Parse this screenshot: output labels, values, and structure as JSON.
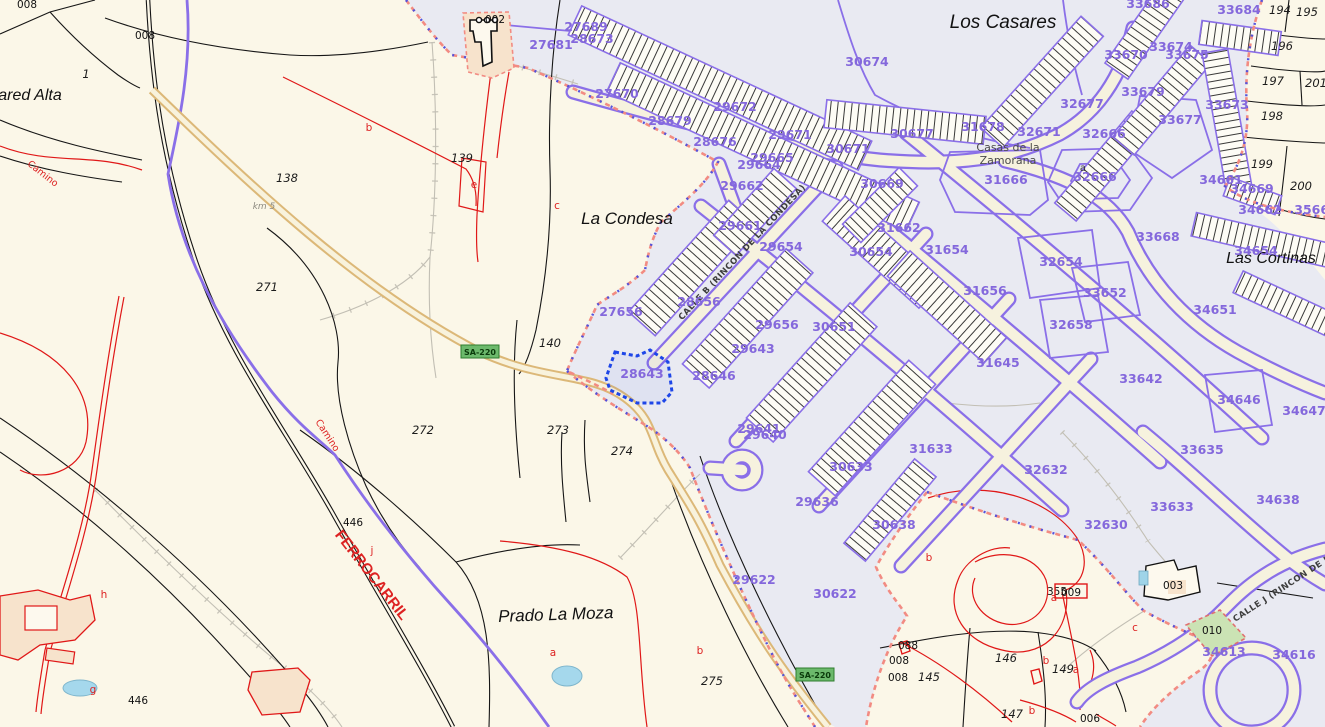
{
  "map": {
    "highlighted_parcel": "28643",
    "colors": {
      "rural_bg": "#FBF7E8",
      "urban_bg": "#E9EAF2",
      "parcel_purple": "#8A6FE8",
      "label_purple": "#8468DC",
      "boundary_red": "#DD2222",
      "road_fill": "#EFD29A",
      "road_edge": "#DCB878",
      "badge_green": "#6CB96C",
      "highlight_blue": "#1E46E8",
      "water_blue": "#A5D8EC",
      "building_beige": "#F7E3CC",
      "green_parcel": "#CBE3B4"
    },
    "place_names": [
      {
        "text": "Los Casares",
        "x": 1003,
        "y": 28,
        "size": 19,
        "angle": 0
      },
      {
        "text": "La Condesa",
        "x": 627,
        "y": 224,
        "size": 17,
        "angle": 0
      },
      {
        "text": "Prado La Moza",
        "x": 556,
        "y": 620,
        "size": 17,
        "angle": -2
      },
      {
        "text": "Las Cortinas",
        "x": 1271,
        "y": 263,
        "size": 16,
        "angle": 0
      },
      {
        "text": "ared Alta",
        "x": 30,
        "y": 100,
        "size": 16,
        "angle": 0
      }
    ],
    "settlement_names": [
      {
        "text": "Casas de la",
        "x": 1008,
        "y": 151
      },
      {
        "text": "Zamorana",
        "x": 1008,
        "y": 164
      }
    ],
    "street_names": [
      {
        "text": "CALLE B (RINCON DE LA CONDESA)",
        "x": 744,
        "y": 254,
        "angle": -47
      },
      {
        "text": "CALLE J (RINCON DE LA",
        "x": 1286,
        "y": 589,
        "angle": -33
      }
    ],
    "railway_label": {
      "text": "FERROCARRIL",
      "x": 368,
      "y": 578,
      "angle": 52,
      "size": 15
    },
    "path_labels": [
      {
        "text": "Camino",
        "x": 41,
        "y": 176,
        "angle": 38
      },
      {
        "text": "Camino",
        "x": 325,
        "y": 437,
        "angle": 57
      }
    ],
    "road_badges": [
      {
        "text": "SA-220",
        "x": 480,
        "y": 352
      },
      {
        "text": "SA-220",
        "x": 815,
        "y": 675
      }
    ],
    "km_marker": {
      "text": "km 5",
      "x": 264,
      "y": 209
    },
    "boxed_label": {
      "text": "009",
      "x": 1071,
      "y": 594
    },
    "parcel_labels_urban": [
      {
        "t": "27689",
        "x": 586,
        "y": 31
      },
      {
        "t": "28673",
        "x": 592,
        "y": 43
      },
      {
        "t": "27681",
        "x": 551,
        "y": 49
      },
      {
        "t": "27670",
        "x": 617,
        "y": 98
      },
      {
        "t": "28679",
        "x": 670,
        "y": 125
      },
      {
        "t": "28676",
        "x": 715,
        "y": 146
      },
      {
        "t": "29672",
        "x": 735,
        "y": 111
      },
      {
        "t": "29671",
        "x": 790,
        "y": 139
      },
      {
        "t": "29665",
        "x": 772,
        "y": 162
      },
      {
        "t": "29664",
        "x": 759,
        "y": 169
      },
      {
        "t": "29662",
        "x": 742,
        "y": 190
      },
      {
        "t": "30674",
        "x": 867,
        "y": 66
      },
      {
        "t": "30671",
        "x": 848,
        "y": 153
      },
      {
        "t": "29661",
        "x": 740,
        "y": 230
      },
      {
        "t": "29654",
        "x": 781,
        "y": 251
      },
      {
        "t": "30669",
        "x": 882,
        "y": 188
      },
      {
        "t": "31662",
        "x": 899,
        "y": 232
      },
      {
        "t": "30654",
        "x": 871,
        "y": 256
      },
      {
        "t": "31654",
        "x": 947,
        "y": 254
      },
      {
        "t": "31666",
        "x": 1006,
        "y": 184
      },
      {
        "t": "32666",
        "x": 1104,
        "y": 138
      },
      {
        "t": "32666",
        "x": 1095,
        "y": 181
      },
      {
        "t": "30677",
        "x": 912,
        "y": 138
      },
      {
        "t": "31678",
        "x": 983,
        "y": 131
      },
      {
        "t": "32671",
        "x": 1039,
        "y": 136
      },
      {
        "t": "32677",
        "x": 1082,
        "y": 108
      },
      {
        "t": "33679",
        "x": 1143,
        "y": 96
      },
      {
        "t": "33670",
        "x": 1126,
        "y": 59
      },
      {
        "t": "33674",
        "x": 1171,
        "y": 51
      },
      {
        "t": "33675",
        "x": 1187,
        "y": 59
      },
      {
        "t": "33686",
        "x": 1148,
        "y": 8
      },
      {
        "t": "33684",
        "x": 1239,
        "y": 14
      },
      {
        "t": "33673",
        "x": 1227,
        "y": 109
      },
      {
        "t": "33677",
        "x": 1180,
        "y": 124
      },
      {
        "t": "34661",
        "x": 1221,
        "y": 184
      },
      {
        "t": "34669",
        "x": 1252,
        "y": 193
      },
      {
        "t": "34662",
        "x": 1260,
        "y": 214
      },
      {
        "t": "35669",
        "x": 1316,
        "y": 214
      },
      {
        "t": "33668",
        "x": 1158,
        "y": 241
      },
      {
        "t": "32654",
        "x": 1061,
        "y": 266
      },
      {
        "t": "33652",
        "x": 1105,
        "y": 297
      },
      {
        "t": "32658",
        "x": 1071,
        "y": 329
      },
      {
        "t": "31656",
        "x": 985,
        "y": 295
      },
      {
        "t": "31645",
        "x": 998,
        "y": 367
      },
      {
        "t": "33642",
        "x": 1141,
        "y": 383
      },
      {
        "t": "34646",
        "x": 1239,
        "y": 404
      },
      {
        "t": "34647",
        "x": 1304,
        "y": 415
      },
      {
        "t": "34651",
        "x": 1215,
        "y": 314
      },
      {
        "t": "34654",
        "x": 1256,
        "y": 255
      },
      {
        "t": "27656",
        "x": 621,
        "y": 316
      },
      {
        "t": "28656",
        "x": 699,
        "y": 306
      },
      {
        "t": "29656",
        "x": 777,
        "y": 329
      },
      {
        "t": "30651",
        "x": 834,
        "y": 331
      },
      {
        "t": "29643",
        "x": 753,
        "y": 353
      },
      {
        "t": "28643",
        "x": 642,
        "y": 378
      },
      {
        "t": "28646",
        "x": 714,
        "y": 380
      },
      {
        "t": "29641",
        "x": 759,
        "y": 433
      },
      {
        "t": "29640",
        "x": 765,
        "y": 439
      },
      {
        "t": "31633",
        "x": 931,
        "y": 453
      },
      {
        "t": "30633",
        "x": 851,
        "y": 471
      },
      {
        "t": "29636",
        "x": 817,
        "y": 506
      },
      {
        "t": "30638",
        "x": 894,
        "y": 529
      },
      {
        "t": "29622",
        "x": 754,
        "y": 584
      },
      {
        "t": "30622",
        "x": 835,
        "y": 598
      },
      {
        "t": "32632",
        "x": 1046,
        "y": 474
      },
      {
        "t": "32630",
        "x": 1106,
        "y": 529
      },
      {
        "t": "33635",
        "x": 1202,
        "y": 454
      },
      {
        "t": "33633",
        "x": 1172,
        "y": 511
      },
      {
        "t": "34638",
        "x": 1278,
        "y": 504
      },
      {
        "t": "34613",
        "x": 1224,
        "y": 656
      },
      {
        "t": "34616",
        "x": 1294,
        "y": 659
      }
    ],
    "parcel_labels_rural": [
      {
        "t": "008",
        "x": 27,
        "y": 8,
        "s": "up"
      },
      {
        "t": "008",
        "x": 145,
        "y": 39,
        "s": "up"
      },
      {
        "t": "1",
        "x": 86,
        "y": 78,
        "s": "it"
      },
      {
        "t": "138",
        "x": 287,
        "y": 182,
        "s": "it"
      },
      {
        "t": "139",
        "x": 462,
        "y": 162,
        "s": "it"
      },
      {
        "t": "140",
        "x": 550,
        "y": 347,
        "s": "it"
      },
      {
        "t": "271",
        "x": 267,
        "y": 291,
        "s": "it"
      },
      {
        "t": "272",
        "x": 423,
        "y": 434,
        "s": "it"
      },
      {
        "t": "273",
        "x": 558,
        "y": 434,
        "s": "it"
      },
      {
        "t": "274",
        "x": 622,
        "y": 455,
        "s": "it"
      },
      {
        "t": "275",
        "x": 712,
        "y": 685,
        "s": "it"
      },
      {
        "t": "446",
        "x": 353,
        "y": 526,
        "s": "up"
      },
      {
        "t": "446",
        "x": 138,
        "y": 704,
        "s": "up"
      },
      {
        "t": "194",
        "x": 1280,
        "y": 14,
        "s": "it"
      },
      {
        "t": "195",
        "x": 1307,
        "y": 16,
        "s": "it"
      },
      {
        "t": "196",
        "x": 1282,
        "y": 50,
        "s": "it"
      },
      {
        "t": "197",
        "x": 1273,
        "y": 85,
        "s": "it"
      },
      {
        "t": "201",
        "x": 1316,
        "y": 87,
        "s": "it"
      },
      {
        "t": "198",
        "x": 1272,
        "y": 120,
        "s": "it"
      },
      {
        "t": "199",
        "x": 1262,
        "y": 168,
        "s": "it"
      },
      {
        "t": "200",
        "x": 1301,
        "y": 190,
        "s": "it"
      },
      {
        "t": "145",
        "x": 929,
        "y": 681,
        "s": "it"
      },
      {
        "t": "146",
        "x": 1006,
        "y": 662,
        "s": "it"
      },
      {
        "t": "147",
        "x": 1012,
        "y": 718,
        "s": "it"
      },
      {
        "t": "149",
        "x": 1063,
        "y": 673,
        "s": "it"
      },
      {
        "t": "088",
        "x": 908,
        "y": 649,
        "s": "up"
      },
      {
        "t": "008",
        "x": 899,
        "y": 664,
        "s": "up"
      },
      {
        "t": "008",
        "x": 898,
        "y": 681,
        "s": "up"
      },
      {
        "t": "006",
        "x": 1090,
        "y": 722,
        "s": "up"
      },
      {
        "t": "002",
        "x": 495,
        "y": 23,
        "s": "up"
      },
      {
        "t": "003",
        "x": 1173,
        "y": 589,
        "s": "up"
      },
      {
        "t": "010",
        "x": 1212,
        "y": 634,
        "s": "up"
      },
      {
        "t": "355",
        "x": 1057,
        "y": 595,
        "s": "up"
      }
    ],
    "subparcel_letters": [
      {
        "t": "b",
        "x": 369,
        "y": 131
      },
      {
        "t": "e",
        "x": 474,
        "y": 188
      },
      {
        "t": "c",
        "x": 557,
        "y": 209
      },
      {
        "t": "a",
        "x": 553,
        "y": 656
      },
      {
        "t": "b",
        "x": 700,
        "y": 654
      },
      {
        "t": "b",
        "x": 929,
        "y": 561
      },
      {
        "t": "a",
        "x": 1054,
        "y": 601
      },
      {
        "t": "c",
        "x": 1135,
        "y": 631
      },
      {
        "t": "b",
        "x": 1046,
        "y": 664
      },
      {
        "t": "a",
        "x": 1076,
        "y": 673
      },
      {
        "t": "b",
        "x": 1032,
        "y": 714
      },
      {
        "t": "g",
        "x": 93,
        "y": 693
      },
      {
        "t": "h",
        "x": 104,
        "y": 598
      },
      {
        "t": "j",
        "x": 372,
        "y": 554
      }
    ],
    "dark_letters": [
      {
        "t": "a",
        "x": 1083,
        "y": 171
      }
    ]
  }
}
